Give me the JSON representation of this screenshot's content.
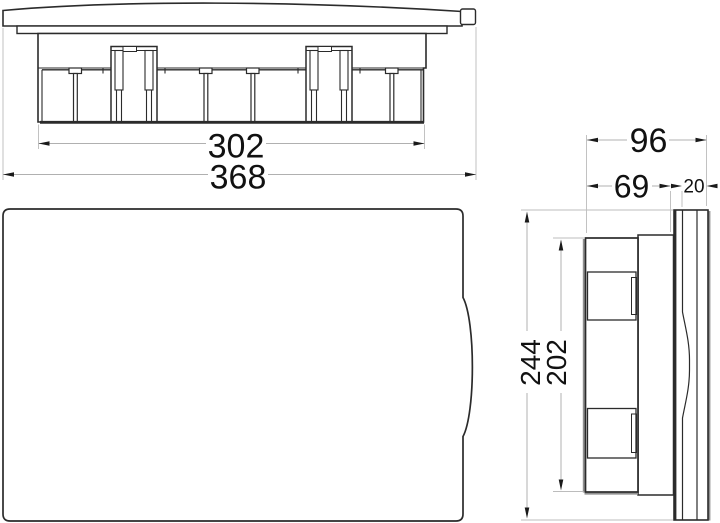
{
  "page": {
    "background": "#ffffff"
  },
  "dims": {
    "d302": "302",
    "d368": "368",
    "d96": "96",
    "d69": "69",
    "d20": "20",
    "d244": "244",
    "d202": "202"
  },
  "drawing_info": {
    "type": "technical-drawing",
    "subject": "flush-mount-enclosure",
    "views": [
      "top",
      "front",
      "side"
    ],
    "colors": {
      "object_line": "#2b2b2b",
      "dimension_line": "#b0b0b0",
      "extension_line": "#bcbcbc",
      "shadow_line": "#8f8f8f",
      "arrow": "#1a1a1a",
      "text": "#111111"
    },
    "measurements_shown": {
      "top_view": {
        "body_width": "302",
        "overall_width": "368"
      },
      "side_view": {
        "overall_depth": "96",
        "box_depth": "69",
        "cover_depth": "20",
        "overall_height": "244",
        "box_height": "202"
      }
    }
  }
}
